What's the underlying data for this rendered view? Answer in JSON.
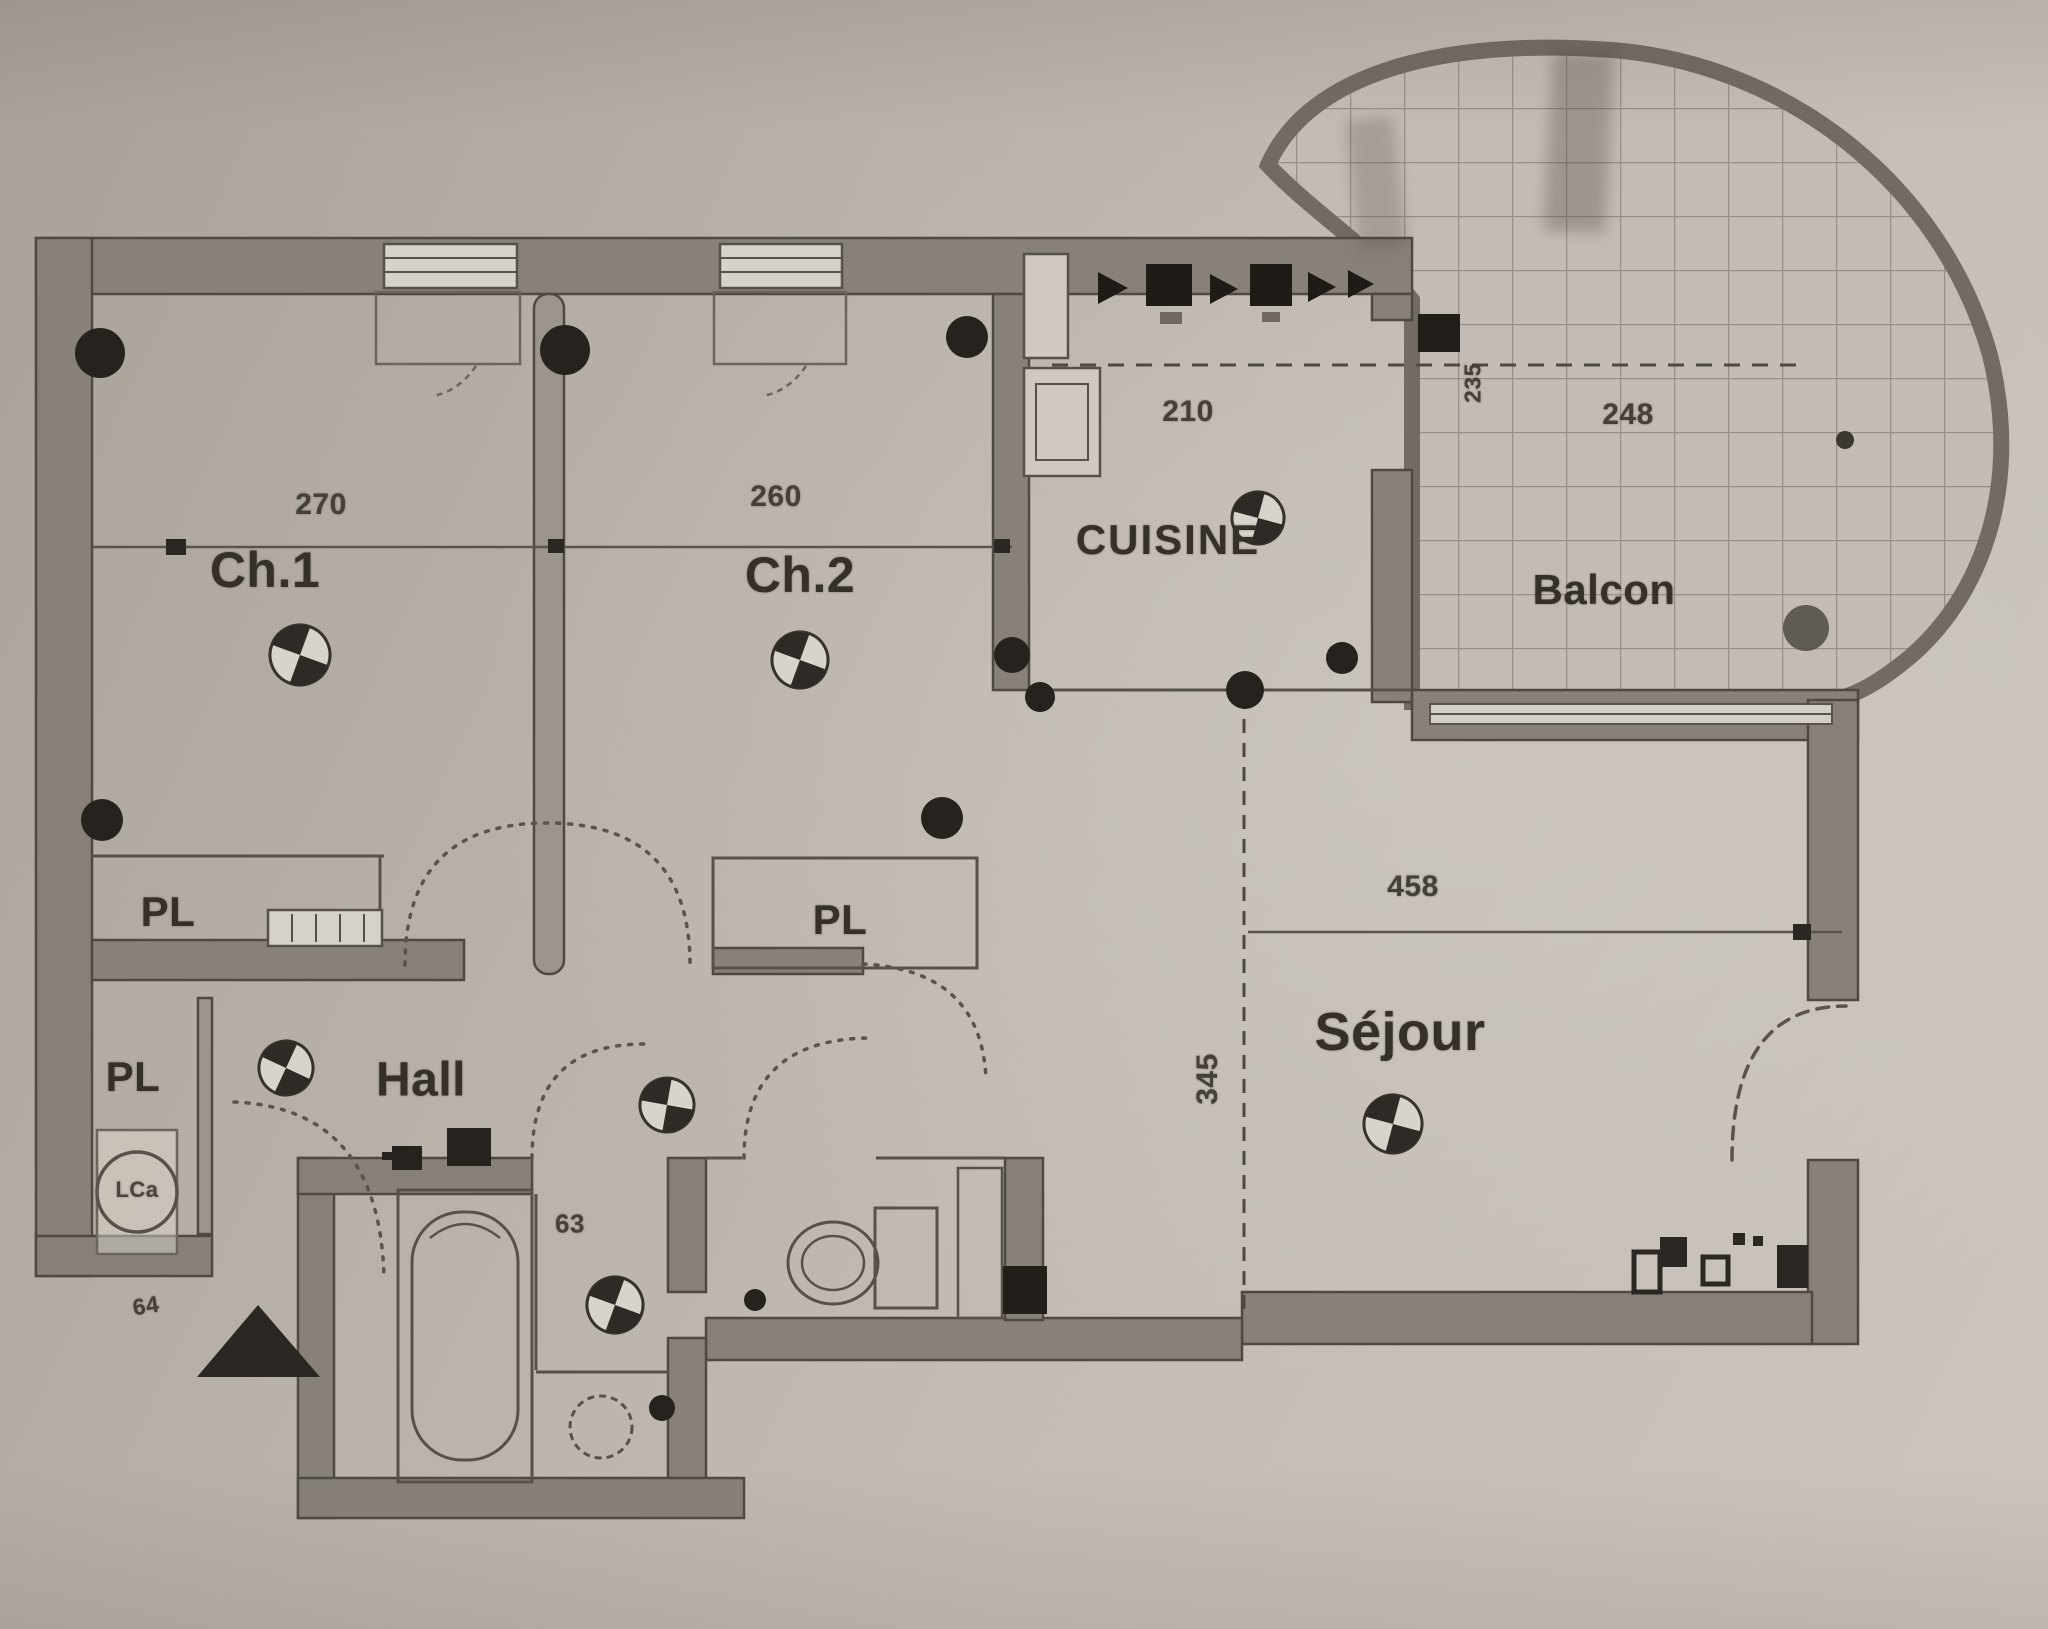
{
  "rooms": [
    {
      "id": "ch1",
      "label": "Ch.1"
    },
    {
      "id": "ch2",
      "label": "Ch.2"
    },
    {
      "id": "cuisine",
      "label": "CUISINE"
    },
    {
      "id": "balcon",
      "label": "Balcon"
    },
    {
      "id": "sejour",
      "label": "Séjour"
    },
    {
      "id": "hall",
      "label": "Hall"
    },
    {
      "id": "pl_ch1",
      "label": "PL"
    },
    {
      "id": "pl_ch2",
      "label": "PL"
    },
    {
      "id": "pl_entree",
      "label": "PL"
    }
  ],
  "dimensions": [
    {
      "id": "ch1_width",
      "label": "270"
    },
    {
      "id": "ch2_width",
      "label": "260"
    },
    {
      "id": "cuisine_width",
      "label": "210"
    },
    {
      "id": "balcon_width",
      "label": "248"
    },
    {
      "id": "balcon_depth",
      "label": "235"
    },
    {
      "id": "sejour_width",
      "label": "458"
    },
    {
      "id": "sejour_depth",
      "label": "345"
    },
    {
      "id": "bath_width",
      "label": "63"
    },
    {
      "id": "entry_width",
      "label": "64"
    }
  ],
  "symbols": {
    "appliance": "LCa"
  },
  "colors": {
    "paper": "#bcb5ad",
    "wall": "#87817a",
    "wall_edge": "#4e4943",
    "ink": "#35302a",
    "tile_line": "#8f8880",
    "tile_fill": "#c2bcb4",
    "symbol_black": "#26221d"
  }
}
